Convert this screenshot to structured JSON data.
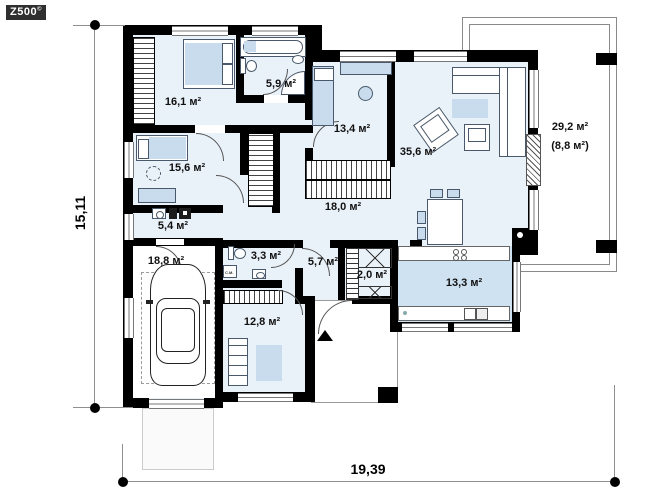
{
  "meta": {
    "logo_text": "Z500",
    "logo_sup": "©"
  },
  "dimensions": {
    "width_label": "19,39",
    "height_label": "15,11"
  },
  "rooms": [
    {
      "name": "bedroom-1",
      "area": "16,1 м²"
    },
    {
      "name": "bathroom",
      "area": "5,9 м²"
    },
    {
      "name": "cabinet",
      "area": "13,4 м²"
    },
    {
      "name": "living-room",
      "area": "35,6 м²"
    },
    {
      "name": "terrace",
      "area": "29,2 м²",
      "area_roofed": "(8,8 м²)"
    },
    {
      "name": "bedroom-2",
      "area": "15,6 м²"
    },
    {
      "name": "corridor",
      "area": "18,0 м²"
    },
    {
      "name": "laundry",
      "area": "5,4 м²"
    },
    {
      "name": "garage",
      "area": "18,8 м²"
    },
    {
      "name": "wc",
      "area": "3,3 м²"
    },
    {
      "name": "hall",
      "area": "5,7 м²"
    },
    {
      "name": "pantry",
      "area": "2,0 м²"
    },
    {
      "name": "kitchen",
      "area": "13,3 м²"
    },
    {
      "name": "utility-room",
      "area": "12,8 м²"
    }
  ],
  "labels": {
    "washer": "С.М."
  },
  "colors": {
    "wall": "#000000",
    "floor": "#eaf2f9",
    "kitchen_floor": "#cfe2f1",
    "furniture": "#c8dcee",
    "logo_bg": "#2f2f2f"
  }
}
